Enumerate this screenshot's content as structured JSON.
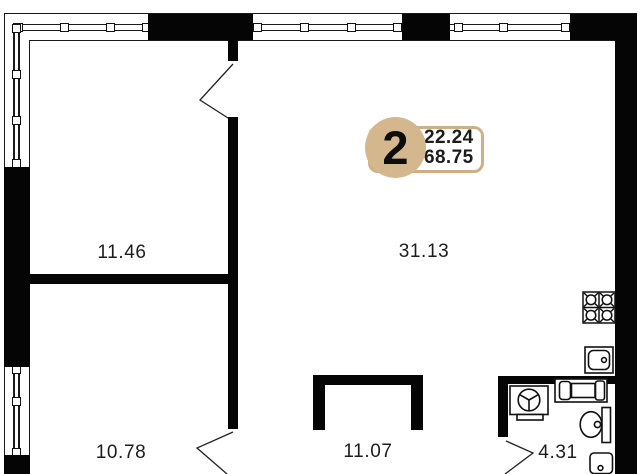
{
  "plan": {
    "badge": {
      "rooms_count": "2",
      "value_top": "22.24",
      "value_bottom": "68.75"
    },
    "rooms": [
      {
        "id": "room-top-left",
        "area": "11.46"
      },
      {
        "id": "living-kitchen",
        "area": "31.13"
      },
      {
        "id": "room-bottom-left",
        "area": "10.78"
      },
      {
        "id": "hall-niche",
        "area": "11.07"
      },
      {
        "id": "bathroom",
        "area": "4.31"
      }
    ],
    "fixtures": [
      "stove-icon",
      "kitchen-sink-icon",
      "bathtub-icon",
      "washing-machine-icon",
      "toilet-icon",
      "bathroom-sink-icon"
    ],
    "colors": {
      "badge_tan": "#d5b78d",
      "badge_border": "#ccb186",
      "wall": "#050505",
      "text": "#1d1d1d"
    }
  }
}
